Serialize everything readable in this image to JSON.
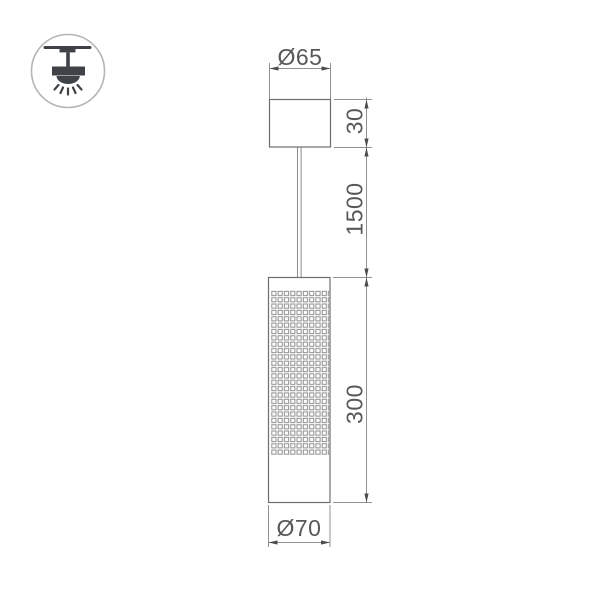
{
  "badge": {
    "icon": "pendant-lamp-ceiling-icon",
    "border_color": "#b5b5b5",
    "glyph_color": "#3f4347"
  },
  "diagram": {
    "type": "technical-dimension-drawing",
    "labels": {
      "canopy_diameter": "Ø65",
      "canopy_height": "30",
      "suspension_length": "1500",
      "body_height": "300",
      "body_diameter": "Ø70"
    },
    "colors": {
      "outline": "#6e6e6e",
      "dimension_line": "#919191",
      "arrow": "#4c4c4c",
      "text": "#58585a",
      "mesh": "#8a8a8a",
      "background": "#ffffff"
    }
  }
}
